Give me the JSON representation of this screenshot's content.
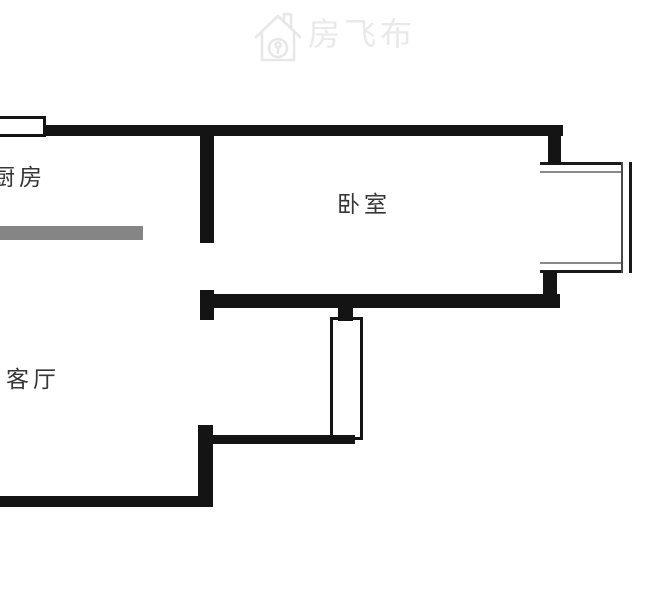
{
  "watermark": {
    "brand_name": "房飞布",
    "icon": "house-logo-icon",
    "color": "#e9e9e9"
  },
  "floorplan": {
    "rooms": [
      {
        "id": "kitchen",
        "label": "厨房"
      },
      {
        "id": "bedroom",
        "label": "卧室"
      },
      {
        "id": "living_room",
        "label": "客厅"
      }
    ],
    "features": [
      "kitchen-window",
      "kitchen-counter",
      "balcony-bay-window",
      "hall-window",
      "door-openings-in-divider-wall"
    ],
    "colors": {
      "wall": "#141414",
      "counter": "#858585",
      "label_text": "#363636",
      "window_fill": "#ffffff",
      "glazing_gray": "#8a8a8a",
      "watermark_gray": "#e9e9e9"
    }
  }
}
